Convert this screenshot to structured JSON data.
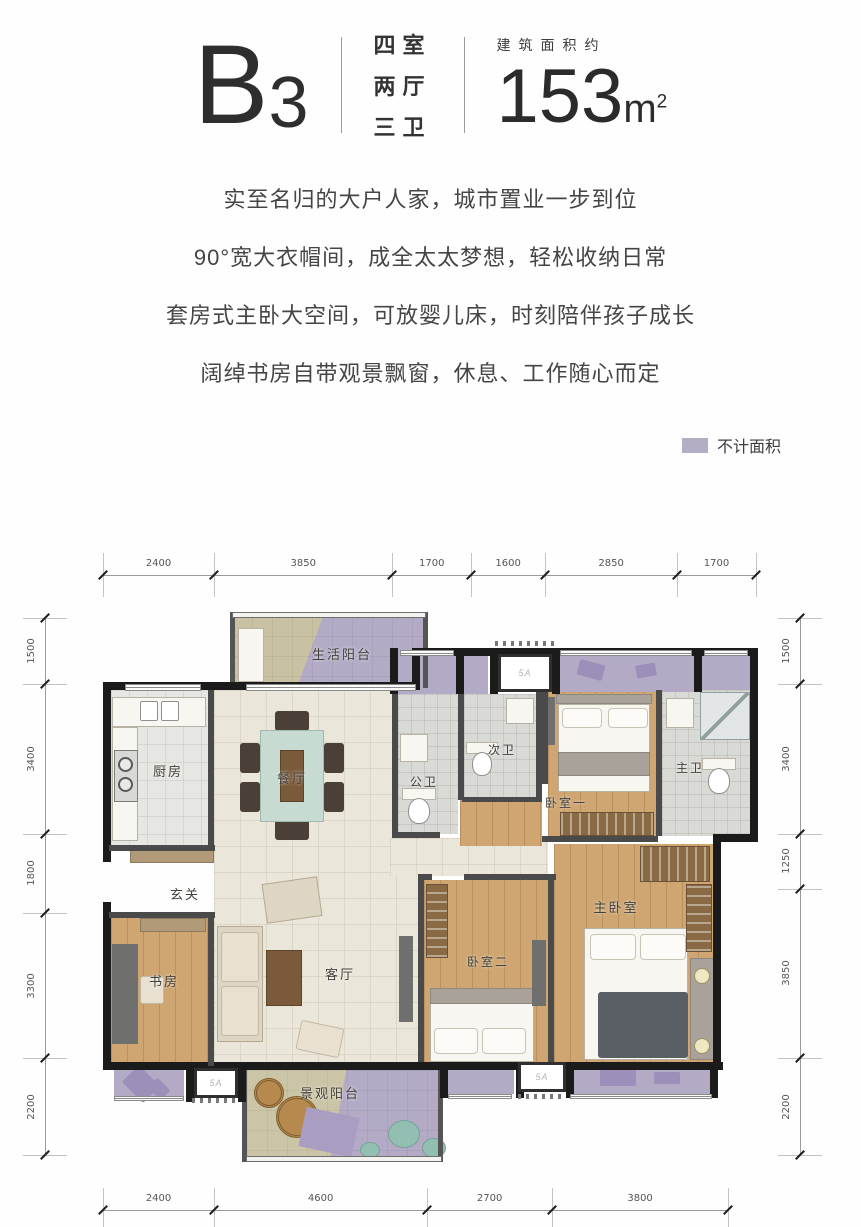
{
  "header": {
    "plan_code_main": "B",
    "plan_code_sub": "3",
    "layout_lines": [
      "四室",
      "两厅",
      "三卫"
    ],
    "area_caption": "建筑面积约",
    "area_value": "153",
    "area_unit": "m",
    "area_sup": "2"
  },
  "marketing": {
    "lines": [
      "实至名归的大户人家，城市置业一步到位",
      "90°宽大衣帽间，成全太太梦想，轻松收纳日常",
      "套房式主卧大空间，可放婴儿床，时刻陪伴孩子成长",
      "阔绰书房自带观景飘窗，休息、工作随心而定"
    ]
  },
  "legend": {
    "label": "不计面积",
    "color": "#b4aec4"
  },
  "plan": {
    "rooms": {
      "service_balcony": "生活阳台",
      "kitchen": "厨房",
      "dining": "餐厅",
      "public_bath": "公卫",
      "second_bath": "次卫",
      "bedroom_one": "卧室一",
      "master_bath": "主卫",
      "entry": "玄关",
      "study": "书房",
      "living": "客厅",
      "bedroom_two": "卧室二",
      "master_bedroom": "主卧室",
      "view_balcony": "景观阳台"
    },
    "ac_label": "5A",
    "dimensions": {
      "top": [
        2400,
        3850,
        1700,
        1600,
        2850,
        1700
      ],
      "bottom": [
        2400,
        4600,
        2700,
        3800
      ],
      "left": [
        1500,
        3400,
        1800,
        3300,
        2200
      ],
      "right": [
        1500,
        3400,
        1250,
        3850,
        2200
      ]
    }
  }
}
